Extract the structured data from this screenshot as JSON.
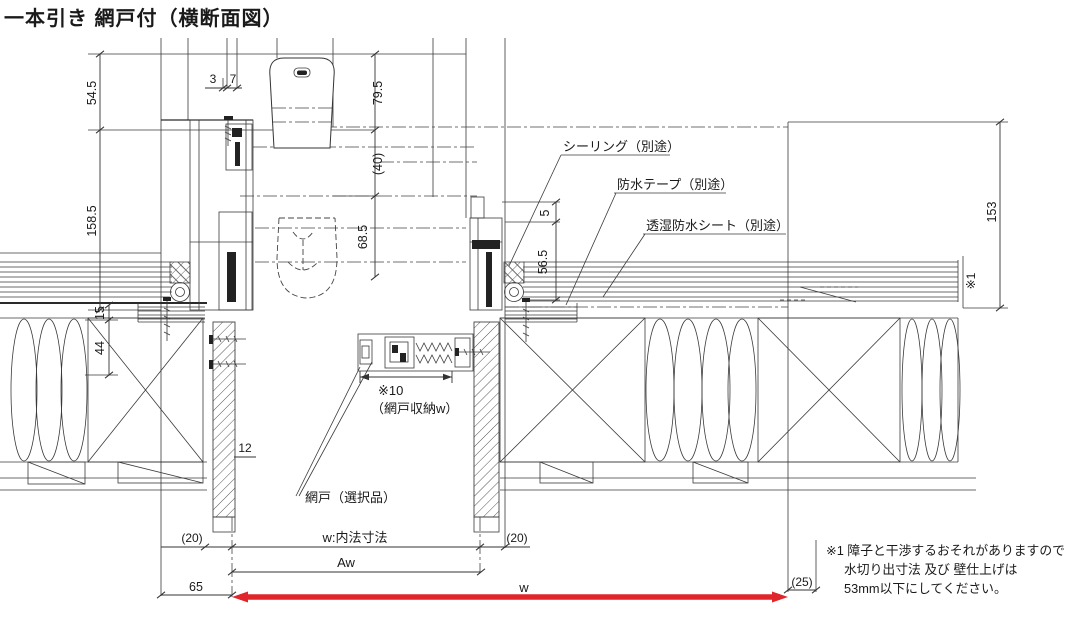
{
  "title": "一本引き 網戸付（横断面図）",
  "callouts": {
    "sealing": "シーリング（別途）",
    "tape": "防水テープ（別途）",
    "sheet": "透湿防水シート（別途）",
    "screen_ref": "※10",
    "screen_width": "（網戸収納w）",
    "screen_door": "網戸（選択品）",
    "wall_ref": "※1"
  },
  "dims": {
    "d54_5": "54.5",
    "d158_5": "158.5",
    "d15": "15",
    "d44": "44",
    "d3": "3",
    "d7": "7",
    "d79_5": "79.5",
    "d40": "(40)",
    "d68_5": "68.5",
    "d5": "5",
    "d56_5": "56.5",
    "d153": "153",
    "d12": "12",
    "gap_left": "(20)",
    "inner_w": "w:内法寸法",
    "gap_right": "(20)",
    "aw": "Aw",
    "d65": "65",
    "w": "w",
    "d25": "(25)"
  },
  "note": {
    "line1": "※1 障子と干渉するおそれがありますので",
    "line2": "水切り出寸法 及び 壁仕上げは",
    "line3": "53mm以下にしてください。"
  },
  "colors": {
    "line": "#3a3a3a",
    "highlight": "#e8262a"
  }
}
